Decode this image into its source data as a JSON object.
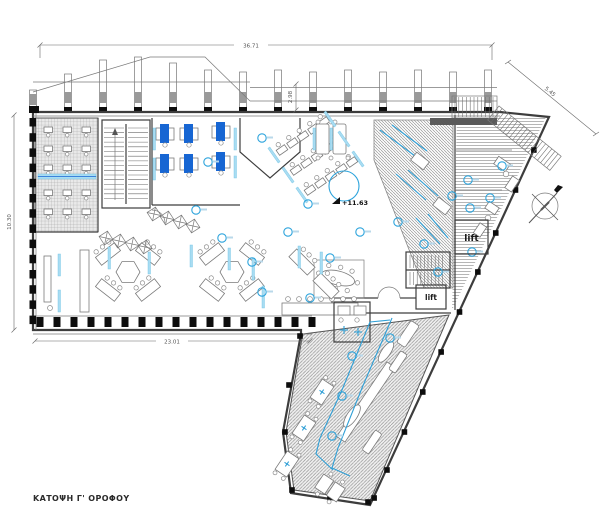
{
  "drawing": {
    "title": "ΚΑΤΟΨΗ Γ' ΟΡΟΦΟΥ",
    "elevation_marker": "+11.63",
    "lift_label_1": "lift",
    "lift_label_2": "lift",
    "dimensions": {
      "top": "36.71",
      "bottom": "23.01",
      "left": "10.30",
      "right_upper": "2.98",
      "diagonal_top_right": "5.45"
    },
    "icons": {
      "north_arrow": "north-arrow-icon",
      "elevation_triangle": "elevation-marker-icon"
    },
    "colors": {
      "desk_blue": "#1766d3",
      "light_cyan": "#a9dcf2",
      "circle_blue": "#2ba3dc",
      "path_blue": "#2f9fd6",
      "wall_dark": "#3d3d3d",
      "wall_black": "#0d0d0d",
      "hatch_gray": "#8f8f8f",
      "dim_gray": "#666666",
      "text_dark": "#2b2b2b",
      "background": "#ffffff"
    }
  }
}
